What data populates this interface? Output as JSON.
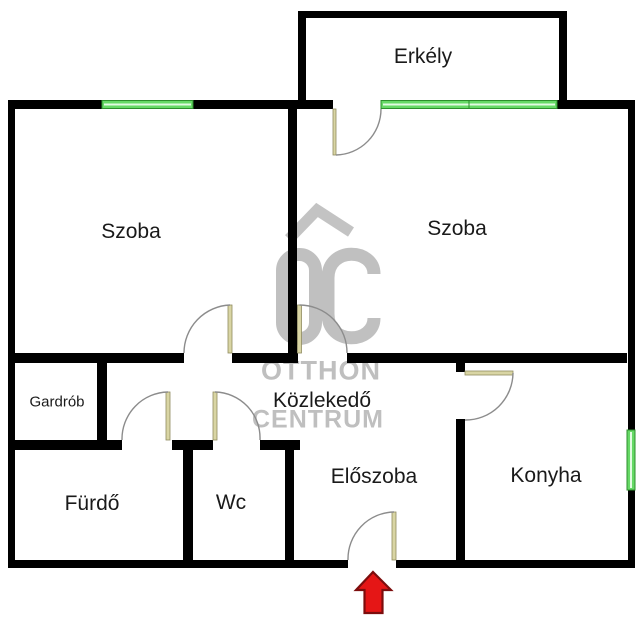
{
  "floorplan": {
    "rooms": [
      {
        "id": "erkely",
        "label": "Erkély"
      },
      {
        "id": "szoba-left",
        "label": "Szoba"
      },
      {
        "id": "szoba-right",
        "label": "Szoba"
      },
      {
        "id": "gardrob",
        "label": "Gardrób"
      },
      {
        "id": "kozlekedo",
        "label": "Közlekedő"
      },
      {
        "id": "furdo",
        "label": "Fürdő"
      },
      {
        "id": "wc",
        "label": "Wc"
      },
      {
        "id": "eloszoba",
        "label": "Előszoba"
      },
      {
        "id": "konyha",
        "label": "Konyha"
      }
    ],
    "watermark": {
      "line1": "OTTHON",
      "line2": "CENTRUM",
      "logo": "OC house logo"
    },
    "entrance_marker": "red arrow pointing up at entrance door",
    "colors": {
      "wall": "#000000",
      "window_green": "#66d966",
      "window_edge": "#2d8f2d",
      "window_highlight": "#e2fbe2",
      "door_leaf": "#d9d5a4",
      "door_leaf_edge": "#8f8b60",
      "door_arc": "#8c8c8c",
      "watermark_gray": "#c0c0c0",
      "arrow_fill": "#e51616",
      "arrow_border": "#7c0d0d",
      "label_text": "#1a1a1a"
    }
  }
}
